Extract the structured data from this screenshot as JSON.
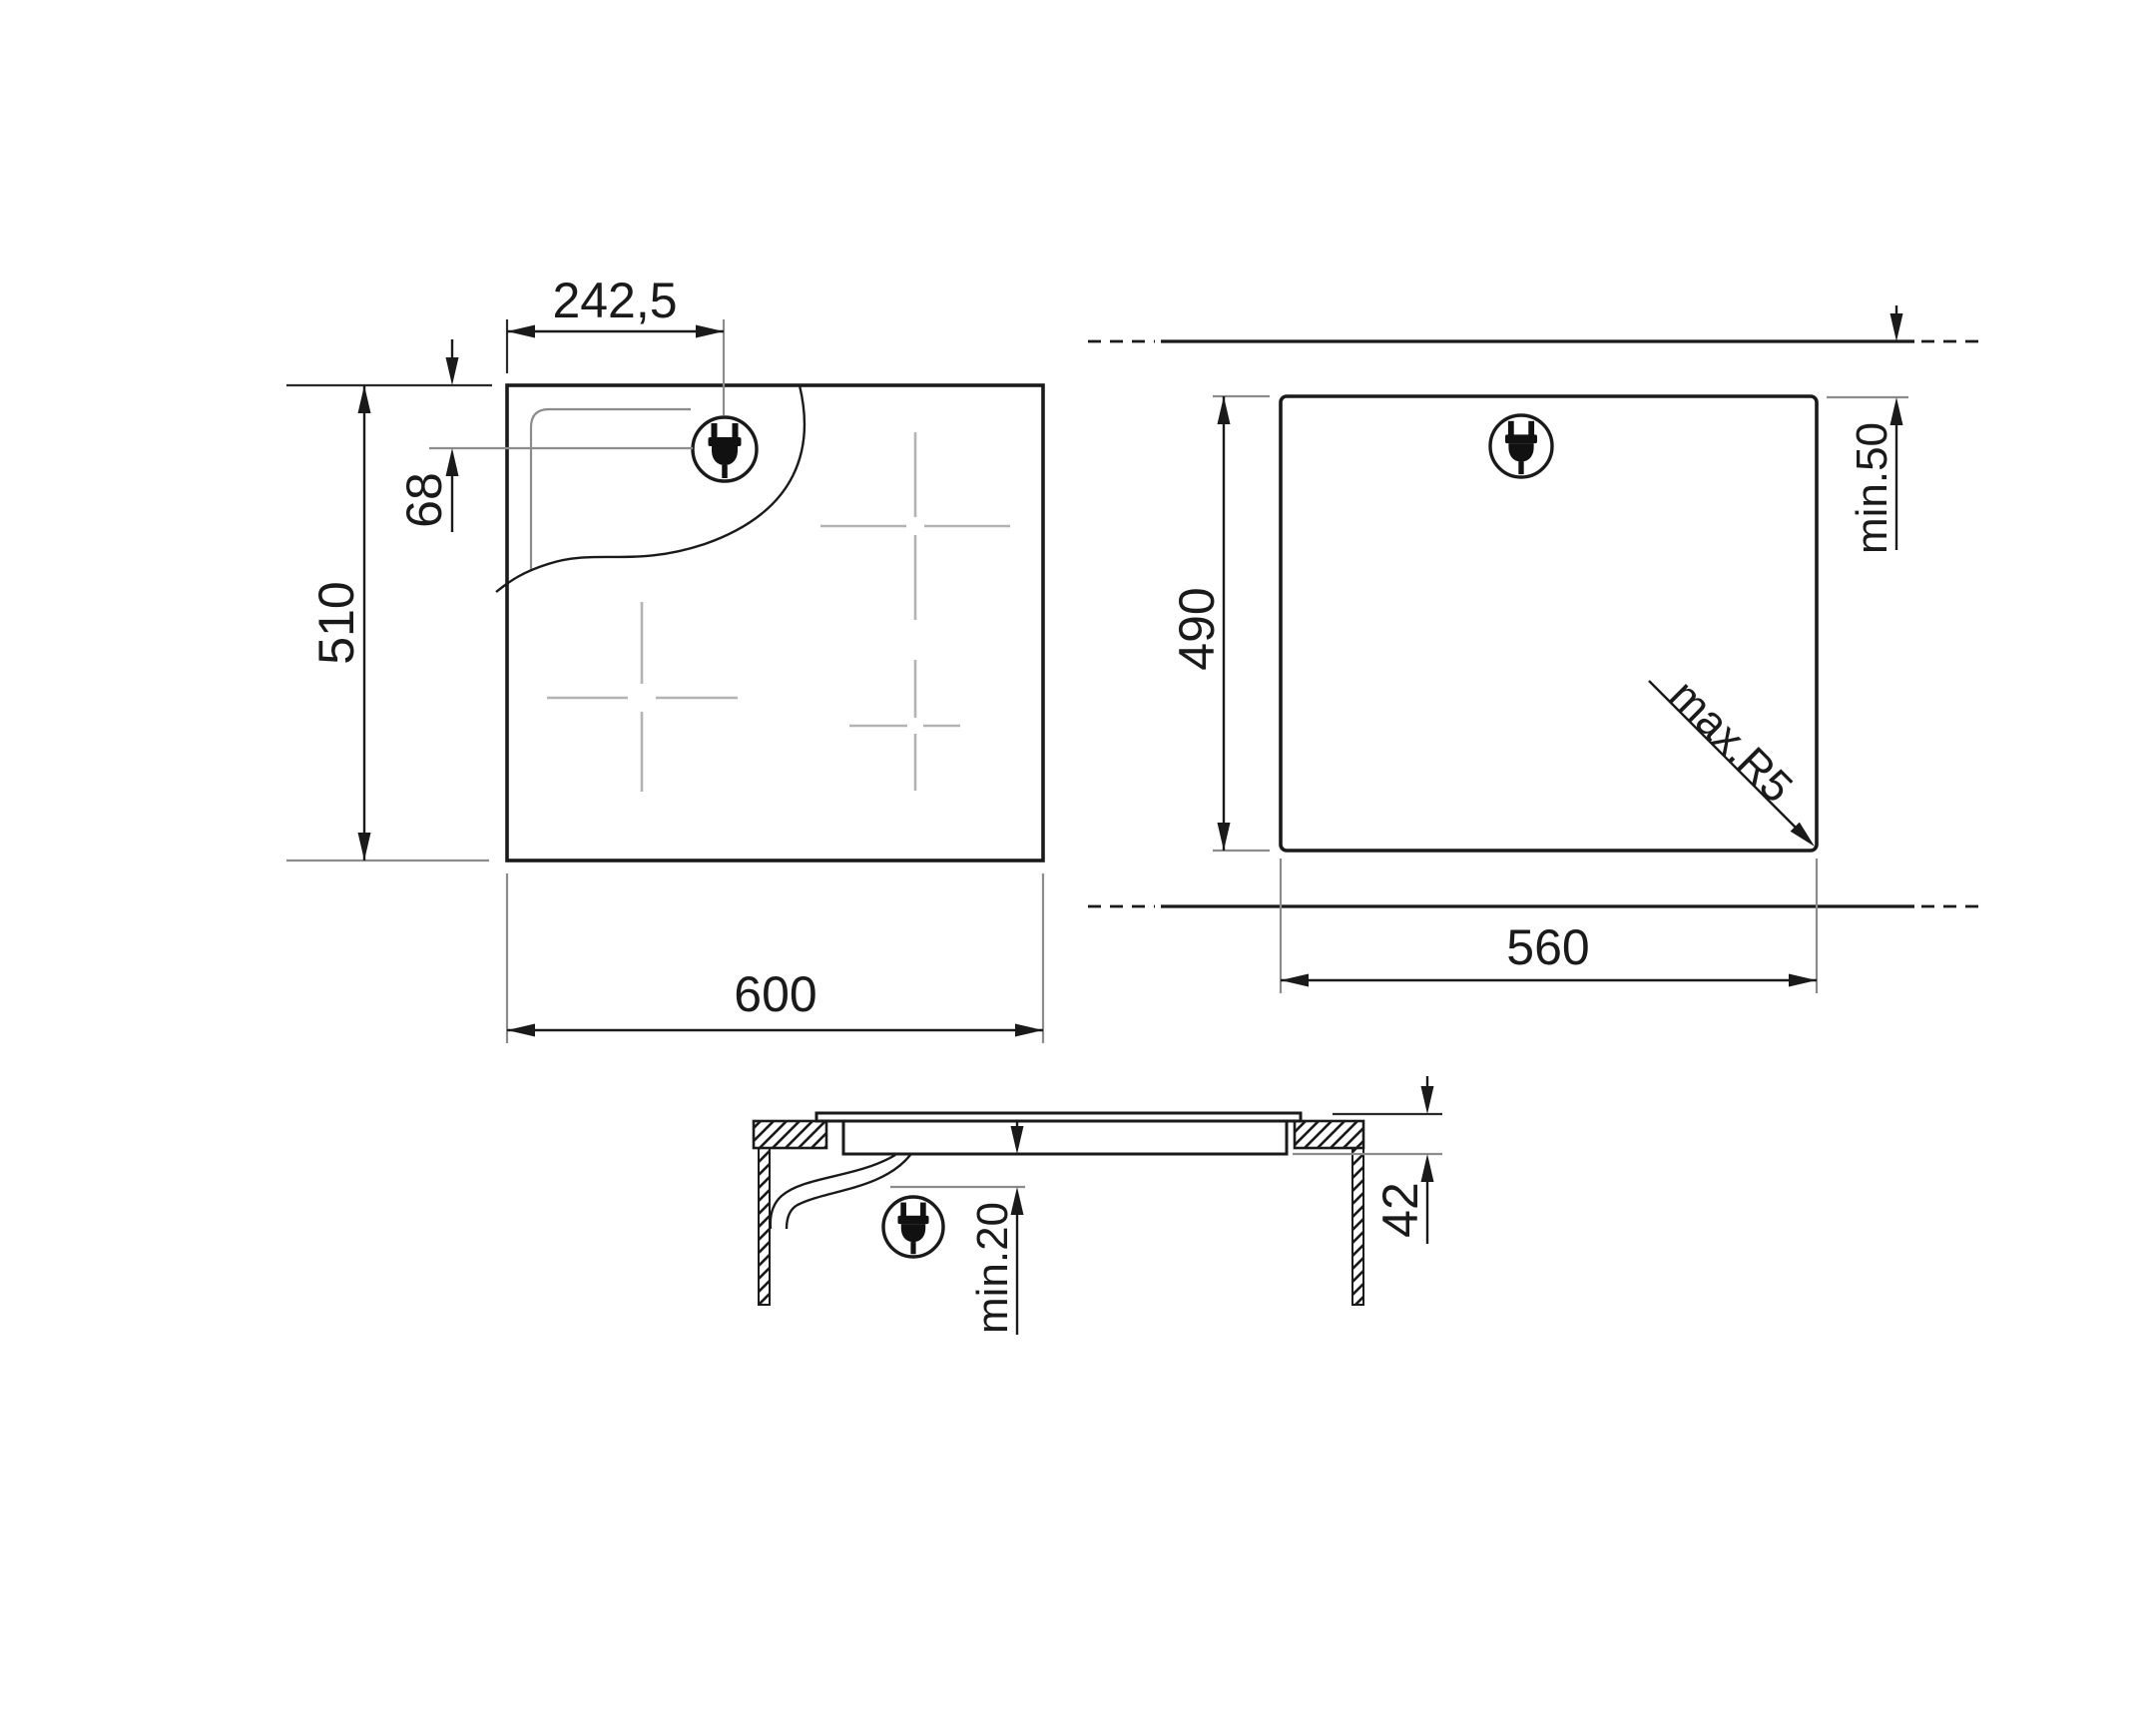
{
  "drawing": {
    "top_view": {
      "plug_offset_x_label": "242,5",
      "plug_offset_y_label": "68",
      "depth_label": "510",
      "width_label": "600"
    },
    "cutout_view": {
      "depth_label": "490",
      "rear_clearance_label": "min.50",
      "corner_radius_label": "max.R5",
      "width_label": "560"
    },
    "section_view": {
      "height_label": "42",
      "clearance_label": "min.20"
    },
    "colors": {
      "line": "#1a1a1a",
      "reference": "#8c8c8c",
      "zone_marker": "#b3b3b3",
      "background": "#ffffff"
    },
    "icons": {
      "plug": "power-plug-icon"
    }
  }
}
